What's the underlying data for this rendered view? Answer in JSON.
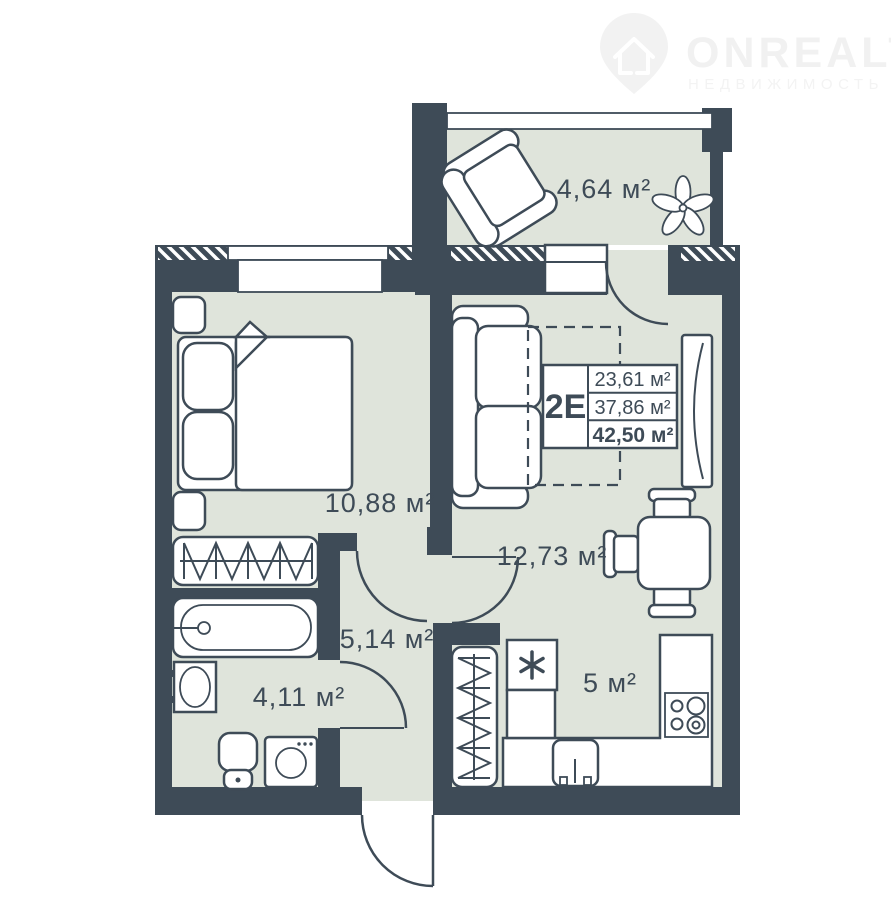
{
  "logo": {
    "brand": "ONREALT",
    "subtitle": "НЕДВИЖИМОСТЬ"
  },
  "unit_card": {
    "unit_label": "2Е",
    "rows": [
      "23,61 м²",
      "37,86 м²",
      "42,50 м²"
    ]
  },
  "rooms": {
    "balcony": "4,64 м²",
    "bedroom": "10,88 м²",
    "living_room": "12,73 м²",
    "hallway": "5,14 м²",
    "bathroom": "4,11 м²",
    "kitchen": "5 м²"
  },
  "colors": {
    "wall": "#3E4B57",
    "floor": "#DFE4DB",
    "furniture_fill": "#FFFFFF",
    "outline": "#3E4B57",
    "watermark": "#F2F2F2"
  }
}
